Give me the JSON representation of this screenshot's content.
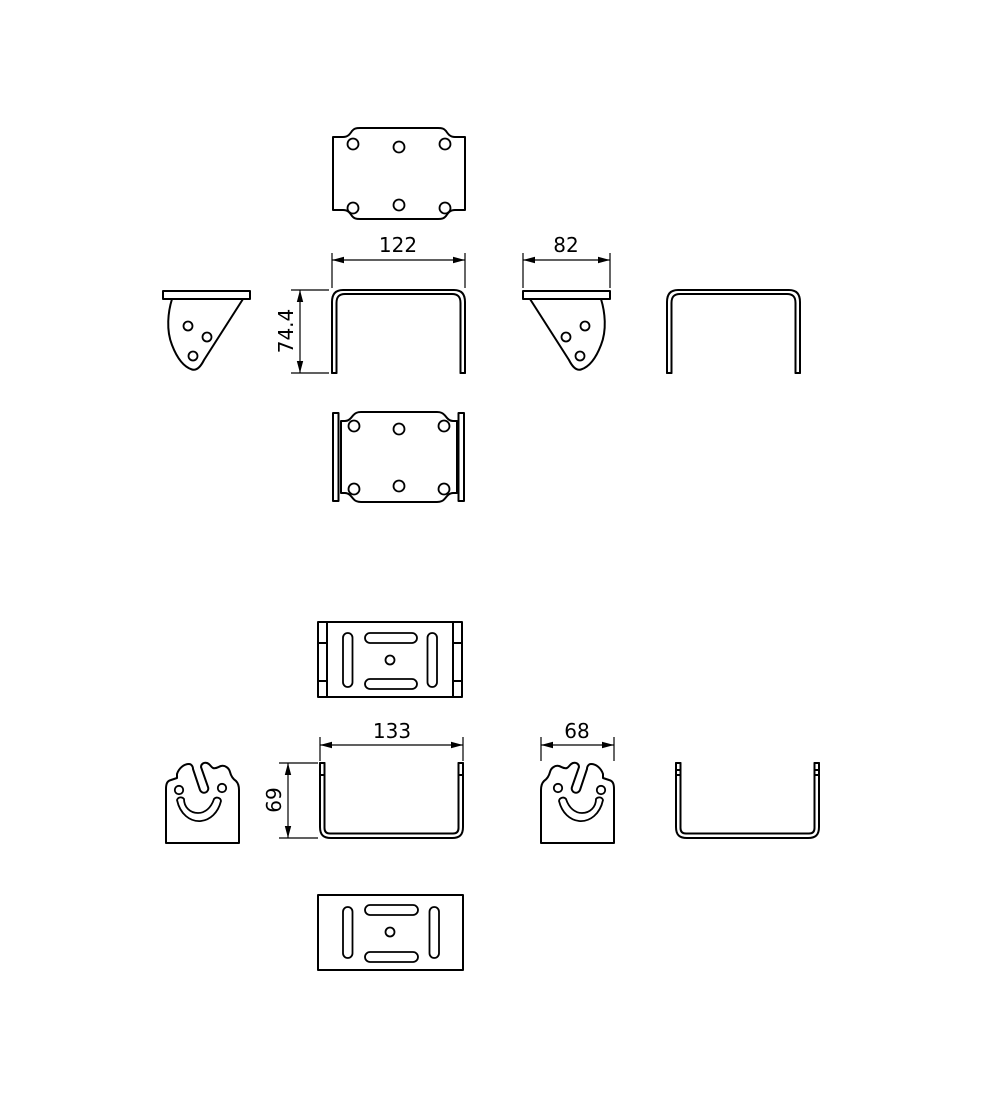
{
  "colors": {
    "background": "#ffffff",
    "line": "#000000"
  },
  "dimensions": {
    "part1": {
      "width": "122",
      "depth": "82",
      "height": "74.4"
    },
    "part2": {
      "width": "133",
      "depth": "68",
      "height": "69"
    }
  }
}
